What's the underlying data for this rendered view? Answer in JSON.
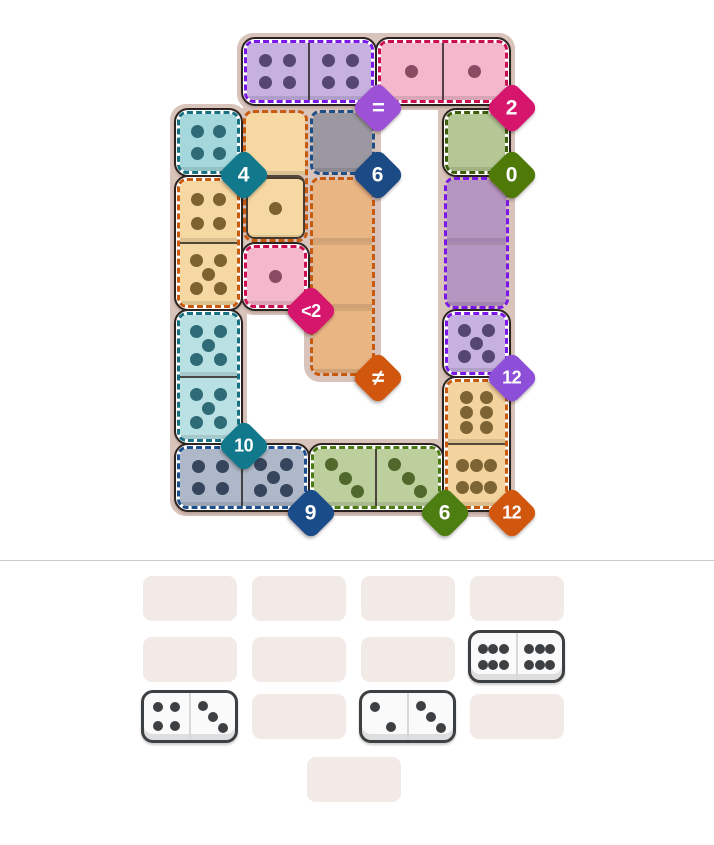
{
  "game": {
    "board": {
      "bg_color": "#d9c4bb",
      "strips": [
        {
          "x": 237,
          "y": 33,
          "w": 278,
          "h": 77
        },
        {
          "x": 438,
          "y": 33,
          "w": 77,
          "h": 484
        },
        {
          "x": 170,
          "y": 104,
          "w": 77,
          "h": 412
        },
        {
          "x": 170,
          "y": 439,
          "w": 345,
          "h": 77
        },
        {
          "x": 237,
          "y": 104,
          "w": 77,
          "h": 211
        },
        {
          "x": 304,
          "y": 104,
          "w": 77,
          "h": 278
        }
      ],
      "regions": [
        {
          "id": "purple-pair-top",
          "dash": "#7a17e8",
          "outlined": true,
          "x": 244,
          "y": 40,
          "w": 130,
          "h": 63,
          "dir": "row",
          "cells": [
            {
              "fill": "#c6b1e0",
              "dots": 4,
              "pattern": "4",
              "dot_color": "#564673"
            },
            {
              "fill": "#c6b1e0",
              "dots": 4,
              "pattern": "4",
              "dot_color": "#564673"
            }
          ]
        },
        {
          "id": "pink-pair-top",
          "dash": "#cc0d52",
          "outlined": true,
          "x": 378,
          "y": 40,
          "w": 130,
          "h": 63,
          "dir": "row",
          "cells": [
            {
              "fill": "#f3b8cb",
              "dots": 1,
              "pattern": "1",
              "dot_color": "#8a4a62"
            },
            {
              "fill": "#f3b8cb",
              "dots": 1,
              "pattern": "1",
              "dot_color": "#8a4a62"
            }
          ]
        },
        {
          "id": "teal-single",
          "dash": "#16707f",
          "outlined": true,
          "x": 177,
          "y": 111,
          "w": 63,
          "h": 63,
          "dir": "row",
          "cells": [
            {
              "fill": "#a4d8dc",
              "dots": 4,
              "pattern": "4",
              "dot_color": "#2e6b77"
            }
          ]
        },
        {
          "id": "wheat-ghost-one",
          "dash": "#c85a0e",
          "outlined": false,
          "x": 244,
          "y": 111,
          "w": 63,
          "h": 130,
          "dir": "col",
          "cells": [
            {
              "fill": "#f6d8a2",
              "dots": 0,
              "dot_color": "#7d6330"
            },
            {
              "fill": "#f6d8a2",
              "dots": 1,
              "pattern": "1",
              "dot_color": "#7d6330",
              "ring": true
            }
          ]
        },
        {
          "id": "gray-ghost",
          "dash": "#1e4f86",
          "outlined": false,
          "x": 311,
          "y": 111,
          "w": 63,
          "h": 63,
          "dir": "col",
          "cells": [
            {
              "fill": "#9b98a2",
              "dots": 0,
              "dot_color": "#555"
            }
          ]
        },
        {
          "id": "green-ghost",
          "dash": "#3c5e0a",
          "outlined": true,
          "x": 445,
          "y": 111,
          "w": 63,
          "h": 63,
          "dir": "col",
          "cells": [
            {
              "fill": "#b4c795",
              "dots": 0,
              "dot_color": "#50682b"
            }
          ]
        },
        {
          "id": "wheat-pair-left",
          "dash": "#c85a0e",
          "outlined": true,
          "x": 177,
          "y": 178,
          "w": 63,
          "h": 130,
          "dir": "col",
          "cells": [
            {
              "fill": "#f6d8a2",
              "dots": 4,
              "pattern": "4",
              "dot_color": "#7d6330"
            },
            {
              "fill": "#f6d8a2",
              "dots": 5,
              "pattern": "5",
              "dot_color": "#7d6330"
            }
          ]
        },
        {
          "id": "orange-ghost-tall",
          "dash": "#c85a0e",
          "outlined": false,
          "x": 311,
          "y": 178,
          "w": 63,
          "h": 197,
          "dir": "col",
          "cells": [
            {
              "fill": "#e9b583",
              "dots": 0,
              "dot_color": "#7d6330"
            },
            {
              "fill": "#e9b583",
              "dots": 0,
              "dot_color": "#7d6330"
            },
            {
              "fill": "#e9b583",
              "dots": 0,
              "dot_color": "#7d6330"
            }
          ]
        },
        {
          "id": "purple-ghost-tall",
          "dash": "#7a17e8",
          "outlined": false,
          "x": 445,
          "y": 178,
          "w": 63,
          "h": 130,
          "dir": "col",
          "cells": [
            {
              "fill": "#b596c1",
              "dots": 0,
              "dot_color": "#564673"
            },
            {
              "fill": "#b596c1",
              "dots": 0,
              "dot_color": "#564673"
            }
          ]
        },
        {
          "id": "pink-single",
          "dash": "#cc0d52",
          "outlined": true,
          "x": 244,
          "y": 245,
          "w": 63,
          "h": 63,
          "dir": "col",
          "cells": [
            {
              "fill": "#f3b8cb",
              "dots": 1,
              "pattern": "1",
              "dot_color": "#8a4a62"
            }
          ]
        },
        {
          "id": "teal-pair-left",
          "dash": "#16707f",
          "outlined": true,
          "x": 177,
          "y": 312,
          "w": 63,
          "h": 130,
          "dir": "col",
          "cells": [
            {
              "fill": "#b9e0e3",
              "dots": 5,
              "pattern": "5",
              "dot_color": "#2e6b77"
            },
            {
              "fill": "#b9e0e3",
              "dots": 5,
              "pattern": "5",
              "dot_color": "#2e6b77"
            }
          ]
        },
        {
          "id": "lavender-single",
          "dash": "#7a17e8",
          "outlined": true,
          "x": 445,
          "y": 312,
          "w": 63,
          "h": 63,
          "dir": "col",
          "cells": [
            {
              "fill": "#c6b1e0",
              "dots": 5,
              "pattern": "5",
              "dot_color": "#564673"
            }
          ]
        },
        {
          "id": "wheat-pair-right",
          "dash": "#c85a0e",
          "outlined": true,
          "x": 445,
          "y": 379,
          "w": 63,
          "h": 130,
          "dir": "col",
          "cells": [
            {
              "fill": "#f3d49e",
              "dots": 6,
              "pattern": "6v",
              "dot_color": "#7c6434"
            },
            {
              "fill": "#f3d49e",
              "dots": 6,
              "pattern": "6h",
              "dot_color": "#7c6434"
            }
          ]
        },
        {
          "id": "bluegray-pair-bottom",
          "dash": "#1d4e8d",
          "outlined": true,
          "x": 177,
          "y": 446,
          "w": 130,
          "h": 63,
          "dir": "row",
          "cells": [
            {
              "fill": "#aeb8c8",
              "dots": 4,
              "pattern": "4",
              "dot_color": "#36455c"
            },
            {
              "fill": "#aeb8c8",
              "dots": 5,
              "pattern": "5",
              "dot_color": "#36455c"
            }
          ]
        },
        {
          "id": "sage-pair-bottom",
          "dash": "#4c7a15",
          "outlined": true,
          "x": 311,
          "y": 446,
          "w": 130,
          "h": 63,
          "dir": "row",
          "cells": [
            {
              "fill": "#bccf9d",
              "dots": 3,
              "pattern": "3",
              "dot_color": "#50682b"
            },
            {
              "fill": "#bccf9d",
              "dots": 3,
              "pattern": "3",
              "dot_color": "#50682b"
            }
          ]
        }
      ],
      "badges": [
        {
          "label": "=",
          "color": "#9c51d6",
          "x": 378,
          "y": 108,
          "size": 22
        },
        {
          "label": "2",
          "color": "#d6156d",
          "x": 512,
          "y": 108,
          "size": 21
        },
        {
          "label": "4",
          "color": "#12798d",
          "x": 244,
          "y": 175,
          "size": 21
        },
        {
          "label": "6",
          "color": "#1c4a85",
          "x": 378,
          "y": 175,
          "size": 21
        },
        {
          "label": "0",
          "color": "#507a08",
          "x": 512,
          "y": 175,
          "size": 21
        },
        {
          "label": "<2",
          "color": "#d6156d",
          "x": 311,
          "y": 311,
          "size": 18
        },
        {
          "label": "≠",
          "color": "#d2570e",
          "x": 378,
          "y": 378,
          "size": 22
        },
        {
          "label": "12",
          "color": "#8d4fd8",
          "x": 512,
          "y": 378,
          "size": 18
        },
        {
          "label": "10",
          "color": "#12798d",
          "x": 244,
          "y": 446,
          "size": 18
        },
        {
          "label": "9",
          "color": "#1b4c8a",
          "x": 311,
          "y": 513,
          "size": 21
        },
        {
          "label": "6",
          "color": "#4c7e12",
          "x": 445,
          "y": 513,
          "size": 21
        },
        {
          "label": "12",
          "color": "#d2570e",
          "x": 512,
          "y": 513,
          "size": 18
        }
      ]
    },
    "tray": {
      "slot_color": "#f2eae7",
      "slots": [
        {
          "x": 143,
          "y": 576,
          "w": 94,
          "h": 45
        },
        {
          "x": 252,
          "y": 576,
          "w": 94,
          "h": 45
        },
        {
          "x": 361,
          "y": 576,
          "w": 94,
          "h": 45
        },
        {
          "x": 470,
          "y": 576,
          "w": 94,
          "h": 45
        },
        {
          "x": 143,
          "y": 637,
          "w": 94,
          "h": 45
        },
        {
          "x": 252,
          "y": 637,
          "w": 94,
          "h": 45
        },
        {
          "x": 361,
          "y": 637,
          "w": 94,
          "h": 45
        },
        {
          "x": 252,
          "y": 694,
          "w": 94,
          "h": 45
        },
        {
          "x": 470,
          "y": 694,
          "w": 94,
          "h": 45
        },
        {
          "x": 307,
          "y": 757,
          "w": 94,
          "h": 45
        }
      ],
      "dominoes": [
        {
          "id": "domino-6-6",
          "x": 468,
          "y": 630,
          "w": 97,
          "h": 53,
          "left": {
            "dots": 6,
            "pattern": "6h"
          },
          "right": {
            "dots": 6,
            "pattern": "6h"
          }
        },
        {
          "id": "domino-4-3",
          "x": 141,
          "y": 690,
          "w": 97,
          "h": 53,
          "left": {
            "dots": 4,
            "pattern": "4"
          },
          "right": {
            "dots": 3,
            "pattern": "3"
          }
        },
        {
          "id": "domino-2-3",
          "x": 359,
          "y": 690,
          "w": 97,
          "h": 53,
          "left": {
            "dots": 2,
            "pattern": "2"
          },
          "right": {
            "dots": 3,
            "pattern": "3"
          }
        }
      ],
      "domino_pip_color": "#3d4043"
    }
  },
  "dot_patterns": {
    "1": [
      [
        50,
        50
      ]
    ],
    "2": [
      [
        30,
        30
      ],
      [
        66,
        72
      ]
    ],
    "3": [
      [
        29,
        27
      ],
      [
        51,
        51
      ],
      [
        72,
        74
      ]
    ],
    "4": [
      [
        31,
        30
      ],
      [
        69,
        30
      ],
      [
        31,
        70
      ],
      [
        69,
        70
      ]
    ],
    "5": [
      [
        29,
        27
      ],
      [
        71,
        27
      ],
      [
        50,
        50
      ],
      [
        29,
        73
      ],
      [
        71,
        73
      ]
    ],
    "6v": [
      [
        33,
        26
      ],
      [
        67,
        26
      ],
      [
        33,
        50
      ],
      [
        67,
        50
      ],
      [
        33,
        74
      ],
      [
        67,
        74
      ]
    ],
    "6h": [
      [
        26,
        33
      ],
      [
        50,
        33
      ],
      [
        74,
        33
      ],
      [
        26,
        69
      ],
      [
        50,
        69
      ],
      [
        74,
        69
      ]
    ]
  }
}
